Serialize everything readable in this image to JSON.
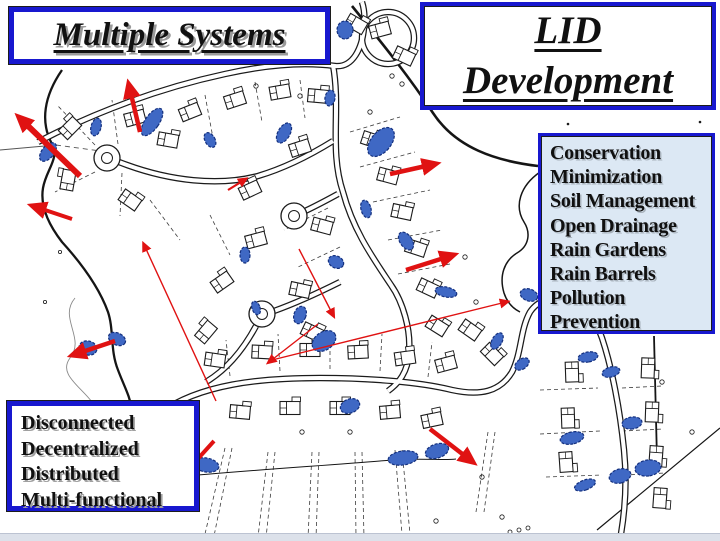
{
  "slide": {
    "bottom_strip_color": "#dce1ea"
  },
  "boxes": {
    "multiple_systems": {
      "title": "Multiple Systems"
    },
    "lid_development": {
      "line1": "LID",
      "line2": "Development"
    },
    "lid_practices": {
      "lines": [
        "Conservation",
        "Minimization",
        "Soil Management",
        "Open Drainage",
        "Rain Gardens",
        "Rain Barrels",
        "Pollution",
        "Prevention"
      ]
    },
    "lid_principles": {
      "lines": [
        "Disconnected",
        "Decentralized",
        "Distributed",
        "Multi-functional"
      ]
    }
  },
  "map": {
    "colors": {
      "linework": "#1b1b1b",
      "lot_line": "#3c3c3c",
      "rain_garden_fill": "#3f68c4",
      "rain_garden_stroke": "#14307e",
      "flow_arrow_red": "#e01212",
      "box_border_blue": "#1818cf",
      "practices_box_bg": "#dce8f4"
    }
  }
}
